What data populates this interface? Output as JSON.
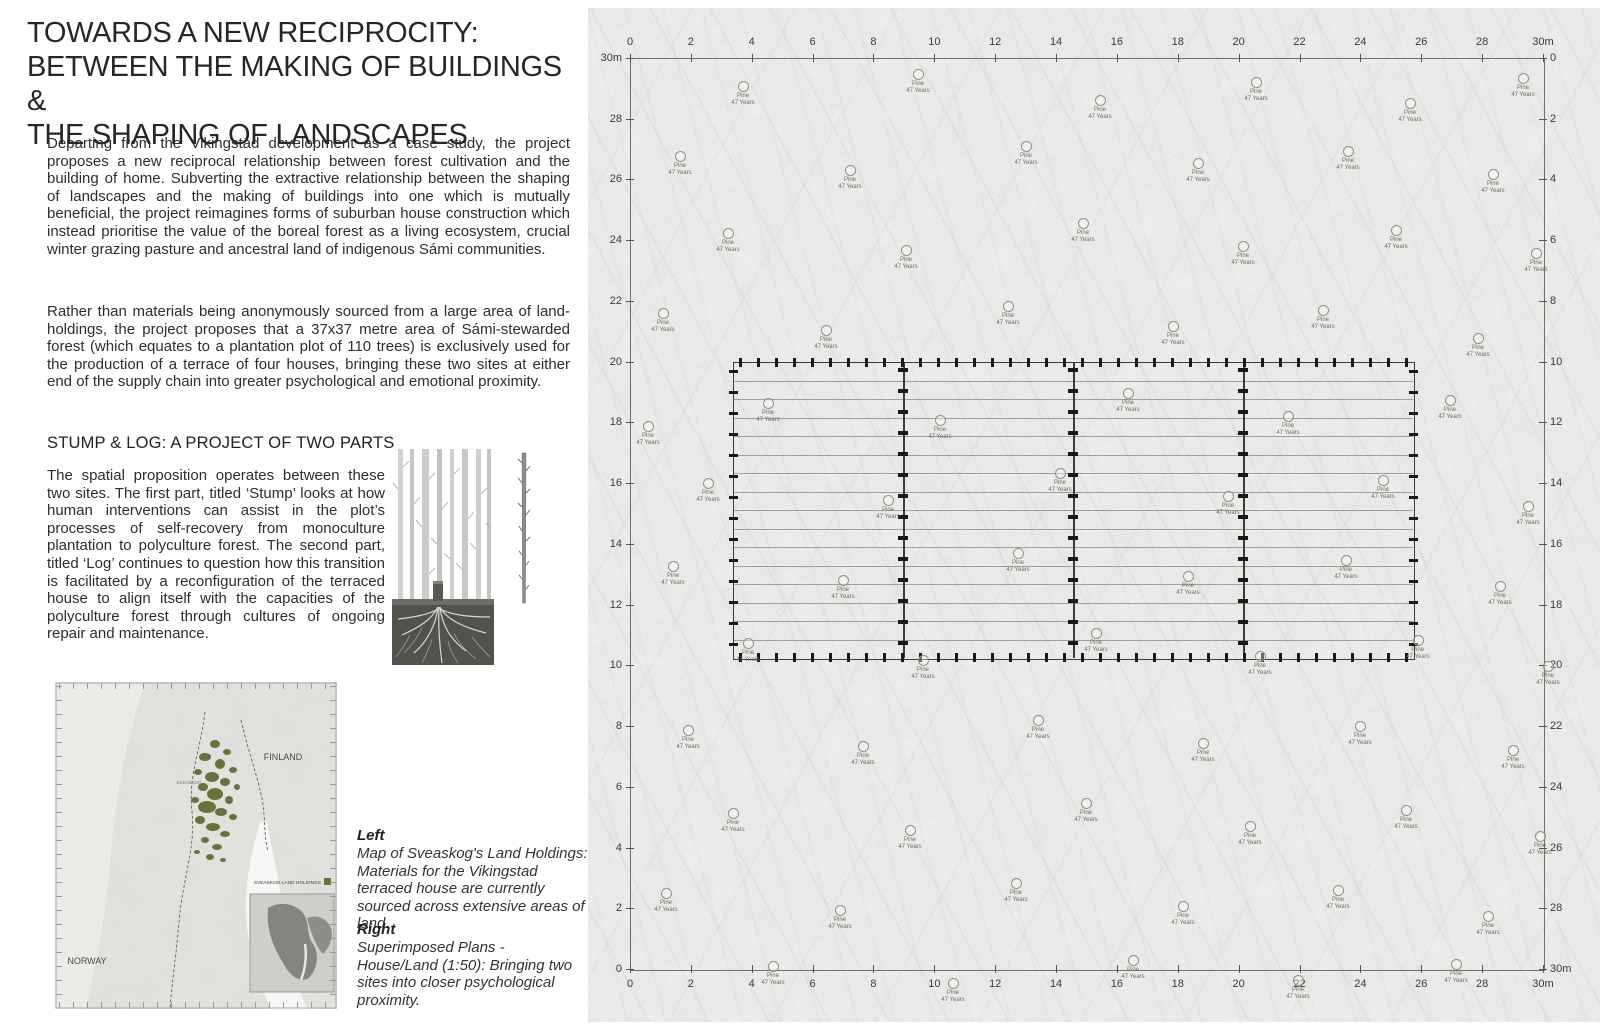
{
  "title": {
    "lines": [
      "TOWARDS A NEW RECIPROCITY:",
      "BETWEEN THE MAKING OF BUILDINGS &",
      "THE SHAPING OF LANDSCAPES"
    ]
  },
  "essay": {
    "p1": "Departing from the Vikingstad development as a case study, the project proposes a new reciprocal relationship between forest cultivation and the building of home. Subverting the extractive relationship between the shaping of landscapes and the making of buildings into one which is mutually beneficial, the project reimagines forms of suburban house construction which instead prioritise the value of the boreal forest as a living ecosystem, crucial winter grazing pasture and ancestral land of indigenous Sámi communities.",
    "p2": "Rather than materials being anonymously sourced from a large area of land-holdings, the project proposes that a 37x37 metre area of Sámi-stewarded forest (which equates to a plantation plot of 110 trees) is exclusively used for the production of a terrace of four houses, bringing these two sites at either end of the supply chain into greater psychological and emotional proximity.",
    "subheading": "STUMP & LOG: A PROJECT OF TWO PARTS",
    "p3": "The spatial proposition operates between these two sites. The first part, titled ‘Stump’ looks at how human interventions can assist in the plot’s processes of self-recovery from monoculture plantation to polyculture forest. The second part, titled ‘Log’ continues to question how this transition is facilitated by a reconfiguration of the terraced house to align itself with the capacities of the polyculture forest through cultures of ongoing repair and maintenance."
  },
  "captions": {
    "left_label": "Left",
    "left_text": "Map of Sveaskog's Land Holdings: Materials for the Vikingstad terraced house are currently sourced across extensive areas of land.",
    "right_label": "Right",
    "right_text": "Superimposed Plans - House/Land (1:50):  Bringing two sites into closer psychological proximity."
  },
  "map": {
    "finland_label": "FINLAND",
    "norway_label": "NORWAY",
    "region_label": "SVEASKOG",
    "legend_label": "SVEASKOG LAND HOLDINGS",
    "holdings_color": "#66743a"
  },
  "plan": {
    "scale_unit": "m",
    "ruler_top": [
      "0",
      "2",
      "4",
      "6",
      "8",
      "10",
      "12",
      "14",
      "16",
      "18",
      "20",
      "22",
      "24",
      "26",
      "28",
      "30m"
    ],
    "ruler_bottom": [
      "0",
      "2",
      "4",
      "6",
      "8",
      "10",
      "12",
      "14",
      "16",
      "18",
      "20",
      "22",
      "24",
      "26",
      "28",
      "30m"
    ],
    "ruler_left": [
      "30m",
      "28",
      "26",
      "24",
      "22",
      "20",
      "18",
      "16",
      "14",
      "12",
      "10",
      "8",
      "6",
      "4",
      "2",
      "0"
    ],
    "ruler_right": [
      "0",
      "2",
      "4",
      "6",
      "8",
      "10",
      "12",
      "14",
      "16",
      "18",
      "20",
      "22",
      "24",
      "26",
      "28",
      "30m"
    ],
    "house_bays": 4,
    "joist_count": 15,
    "tree_label_line1": "Pine",
    "tree_label_line2": "47 Years",
    "trees": [
      [
        155,
        78
      ],
      [
        330,
        66
      ],
      [
        512,
        92
      ],
      [
        668,
        74
      ],
      [
        822,
        95
      ],
      [
        935,
        70
      ],
      [
        92,
        148
      ],
      [
        262,
        162
      ],
      [
        438,
        138
      ],
      [
        610,
        155
      ],
      [
        760,
        143
      ],
      [
        905,
        166
      ],
      [
        140,
        225
      ],
      [
        318,
        242
      ],
      [
        495,
        215
      ],
      [
        655,
        238
      ],
      [
        808,
        222
      ],
      [
        948,
        245
      ],
      [
        75,
        305
      ],
      [
        238,
        322
      ],
      [
        420,
        298
      ],
      [
        585,
        318
      ],
      [
        735,
        302
      ],
      [
        890,
        330
      ],
      [
        180,
        395
      ],
      [
        352,
        412
      ],
      [
        540,
        385
      ],
      [
        700,
        408
      ],
      [
        862,
        392
      ],
      [
        60,
        418
      ],
      [
        120,
        475
      ],
      [
        300,
        492
      ],
      [
        472,
        465
      ],
      [
        640,
        488
      ],
      [
        795,
        472
      ],
      [
        940,
        498
      ],
      [
        85,
        558
      ],
      [
        255,
        572
      ],
      [
        430,
        545
      ],
      [
        600,
        568
      ],
      [
        758,
        552
      ],
      [
        912,
        578
      ],
      [
        160,
        635
      ],
      [
        335,
        652
      ],
      [
        508,
        625
      ],
      [
        672,
        648
      ],
      [
        830,
        632
      ],
      [
        960,
        658
      ],
      [
        100,
        722
      ],
      [
        275,
        738
      ],
      [
        450,
        712
      ],
      [
        615,
        735
      ],
      [
        772,
        718
      ],
      [
        925,
        742
      ],
      [
        145,
        805
      ],
      [
        322,
        822
      ],
      [
        498,
        795
      ],
      [
        662,
        818
      ],
      [
        818,
        802
      ],
      [
        952,
        828
      ],
      [
        78,
        885
      ],
      [
        252,
        902
      ],
      [
        428,
        875
      ],
      [
        595,
        898
      ],
      [
        750,
        882
      ],
      [
        900,
        908
      ],
      [
        185,
        958
      ],
      [
        365,
        975
      ],
      [
        545,
        952
      ],
      [
        710,
        972
      ],
      [
        868,
        956
      ]
    ]
  }
}
